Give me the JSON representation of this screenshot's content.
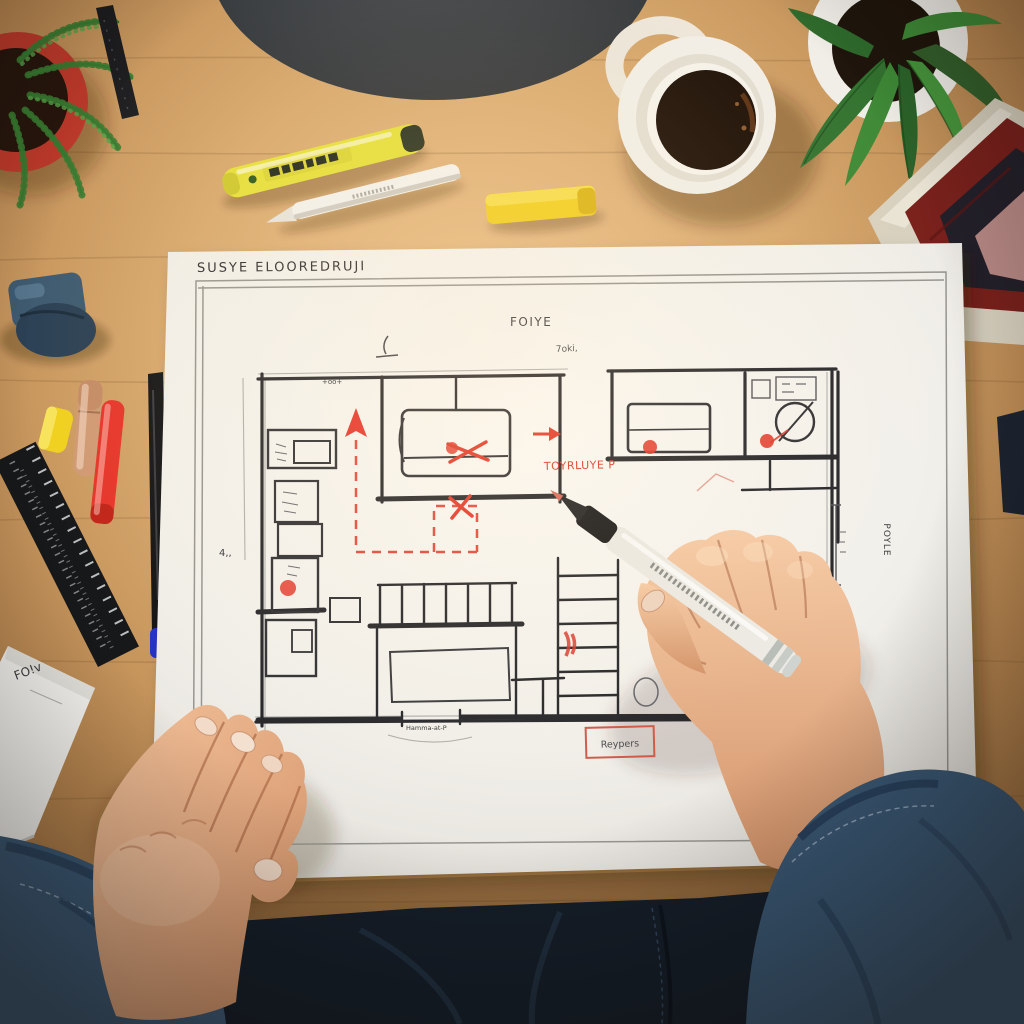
{
  "meta": {
    "type": "photograph",
    "description": "Overhead view of a person sketching a building floor plan with markers on a large sheet of paper at a wooden desk"
  },
  "paper": {
    "title": "SUSYE ELOOREDRUJI",
    "center_label": "FOIYE",
    "small_note": "7oki,",
    "red_annotation": "TOYRLUYE P",
    "boxed_label": "Reypers",
    "side_label": "POYLE",
    "door_label": "Hamma-at-P",
    "dim_top": "+oo+",
    "dim_left": "4,,"
  },
  "notepad": {
    "note": "FO!v"
  },
  "objects": {
    "top": [
      "dark lamp base",
      "red pot with fern",
      "black pencil",
      "yellow highlighter",
      "white stylus pen",
      "yellow eraser",
      "white mug with black coffee",
      "white potted plant",
      "stack of books"
    ],
    "left": [
      "blue sharpener",
      "yellow cap",
      "tan marker",
      "red marker",
      "black ruler",
      "black fineliner with blue cap",
      "white notepad"
    ],
    "center": [
      "hand-drawn floor plan",
      "red dashed route with arrow",
      "red X marks",
      "red boxed label"
    ],
    "bottom": [
      "left hand resting on paper",
      "right hand holding white marker",
      "denim sleeves"
    ]
  },
  "colors": {
    "wood": "#c7995f",
    "paper": "#f4f2ed",
    "ink": "#2a2a2e",
    "annotation_red": "#e03a2c",
    "denim": "#3b5a77",
    "skin": "#e5b18c",
    "mug": "#f2efe8",
    "coffee": "#1f1006",
    "plant_green": "#3f8a37",
    "pot_red": "#bf3a2b",
    "highlighter_yellow": "#e6e03a",
    "eraser_yellow": "#f2cf1f",
    "marker_red": "#e6352a",
    "marker_tan": "#d09a74",
    "ruler_black": "#17181a",
    "notepad_white": "#f7f6f2"
  }
}
